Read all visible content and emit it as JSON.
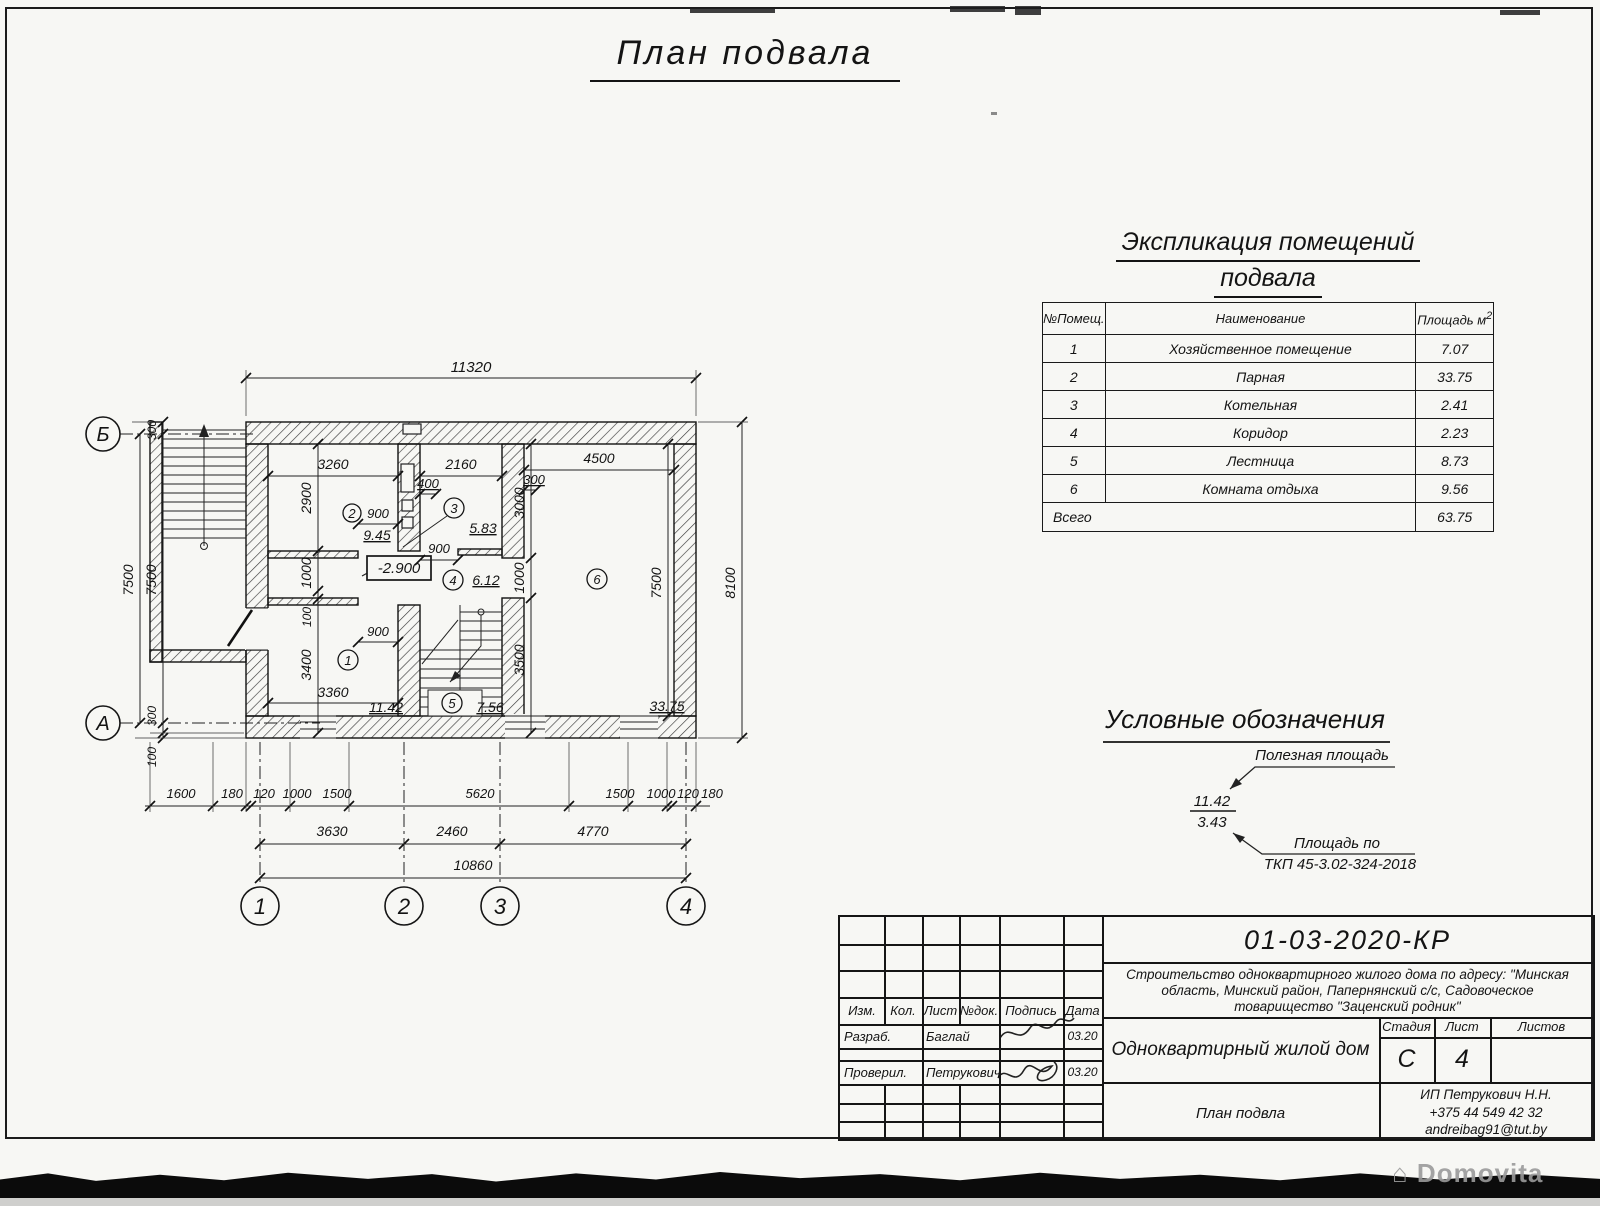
{
  "sheet": {
    "title": "План подвала"
  },
  "explication": {
    "title1": "Экспликация помещений",
    "title2": "подвала",
    "h_num": "№Помещ.",
    "h_name": "Наименование",
    "h_area": "Площадь м",
    "h_area_sup": "2",
    "rows": [
      {
        "num": "1",
        "name": "Хозяйственное помещение",
        "area": "7.07"
      },
      {
        "num": "2",
        "name": "Парная",
        "area": "33.75"
      },
      {
        "num": "3",
        "name": "Котельная",
        "area": "2.41"
      },
      {
        "num": "4",
        "name": "Коридор",
        "area": "2.23"
      },
      {
        "num": "5",
        "name": "Лестница",
        "area": "8.73"
      },
      {
        "num": "6",
        "name": "Комната отдыха",
        "area": "9.56"
      }
    ],
    "total_label": "Всего",
    "total_value": "63.75"
  },
  "legend": {
    "title": "Условные обозначения",
    "useful": "Полезная площадь",
    "frac_top": "11.42",
    "frac_bot": "3.43",
    "tkp1": "Площадь по",
    "tkp2": "ТКП 45-3.02-324-2018"
  },
  "plan": {
    "axes": {
      "c1": "1",
      "c2": "2",
      "c3": "3",
      "c4": "4",
      "rB": "Б",
      "rA": "А"
    },
    "rooms": {
      "r1": "1",
      "r2": "2",
      "r3": "3",
      "r4": "4",
      "r5": "5",
      "r6": "6"
    },
    "areas": {
      "r1": "11.42",
      "r2": "9.45",
      "r3": "5.83",
      "r4": "6.12",
      "r5": "7.56",
      "r6": "33.75"
    },
    "level": "-2.900",
    "dims": {
      "top": "11320",
      "t1": "3260",
      "t2": "2160",
      "t3": "4500",
      "v2900": "2900",
      "v400": "400",
      "v300": "300",
      "v3000": "3000",
      "door2": "900",
      "door3": "900",
      "door1": "900",
      "corrR": "1000",
      "corrL": "1000",
      "off100": "100",
      "r1h": "3400",
      "r1w": "3360",
      "stairH": "3500",
      "r6h": "7500",
      "rightAll": "8100",
      "l300t": "300",
      "l7500o": "7500",
      "l7500i": "7500",
      "l300b": "300",
      "l100": "100",
      "b1": [
        "1600",
        "180",
        "120",
        "1000",
        "1500",
        "5620",
        "1500",
        "1000",
        "120",
        "180"
      ],
      "b2": [
        "3630",
        "2460",
        "4770"
      ],
      "b3": "10860"
    }
  },
  "title_block": {
    "doc_number": "01-03-2020-КР",
    "desc1": "Строительство одноквартирного жилого дома по адресу: \"Минская",
    "desc2": "область, Минский район, Папернянский с/с, Садовоческое",
    "desc3": "товарищество \"Заценский родник\"",
    "object_name": "Одноквартирный жилой дом",
    "drawing_name": "План подвла",
    "cols": {
      "izm": "Изм.",
      "kol": "Кол.",
      "list": "Лист",
      "ndok": "№док.",
      "podpis": "Подпись",
      "data": "Дата"
    },
    "razrab_label": "Разраб.",
    "razrab_name": "Баглай",
    "razrab_date": "03.20",
    "proveril_label": "Проверил.",
    "proveril_name": "Петрукович",
    "proveril_date": "03.20",
    "stage_label": "Стадия",
    "sheet_label": "Лист",
    "sheets_label": "Листов",
    "stage": "С",
    "sheet_num": "4",
    "sheets_total": "",
    "company1": "ИП Петрукович Н.Н.",
    "company2": "+375 44 549 42 32",
    "company3": "andreibag91@tut.by"
  },
  "page": {
    "watermark": "⌂ Domovita"
  }
}
